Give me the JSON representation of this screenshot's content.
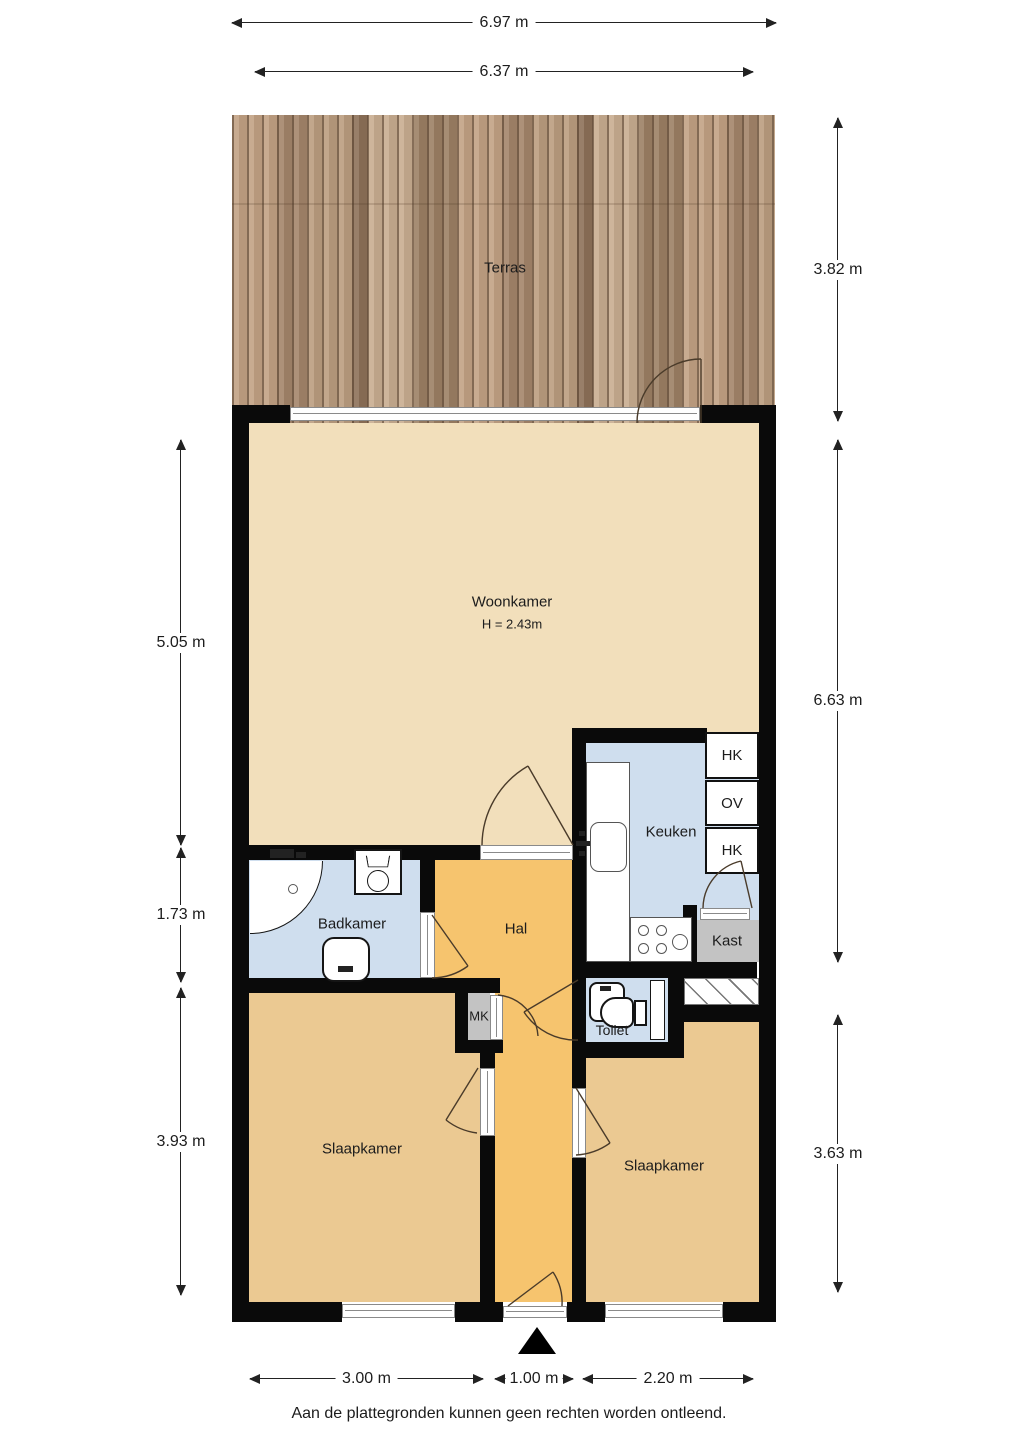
{
  "rooms": {
    "terras": "Terras",
    "woonkamer": "Woonkamer",
    "woonkamer_height": "H = 2.43m",
    "keuken": "Keuken",
    "badkamer": "Badkamer",
    "hal": "Hal",
    "toilet": "Toilet",
    "mk": "MK",
    "kast": "Kast",
    "slaapkamer_left": "Slaapkamer",
    "slaapkamer_right": "Slaapkamer",
    "hk_top": "HK",
    "ov": "OV",
    "hk_bottom": "HK"
  },
  "dimensions": {
    "top_outer": "6.97 m",
    "top_inner": "6.37 m",
    "terrace_right": "3.82 m",
    "living_left": "5.05 m",
    "main_right": "6.63 m",
    "bath_left": "1.73 m",
    "bedroom_left": "3.93 m",
    "bedroom_right": "3.63 m",
    "bottom_left": "3.00 m",
    "bottom_center": "1.00 m",
    "bottom_right": "2.20 m"
  },
  "footer": {
    "disclaimer": "Aan de plattegronden kunnen geen rechten worden ontleend."
  },
  "colors": {
    "living": "#f2dfbb",
    "bedroom": "#ebc992",
    "hall": "#f6c46e",
    "wet": "#cfdeee",
    "closet": "#c3c3c3",
    "wall": "#0a0a0a",
    "wood": "#b49879"
  }
}
